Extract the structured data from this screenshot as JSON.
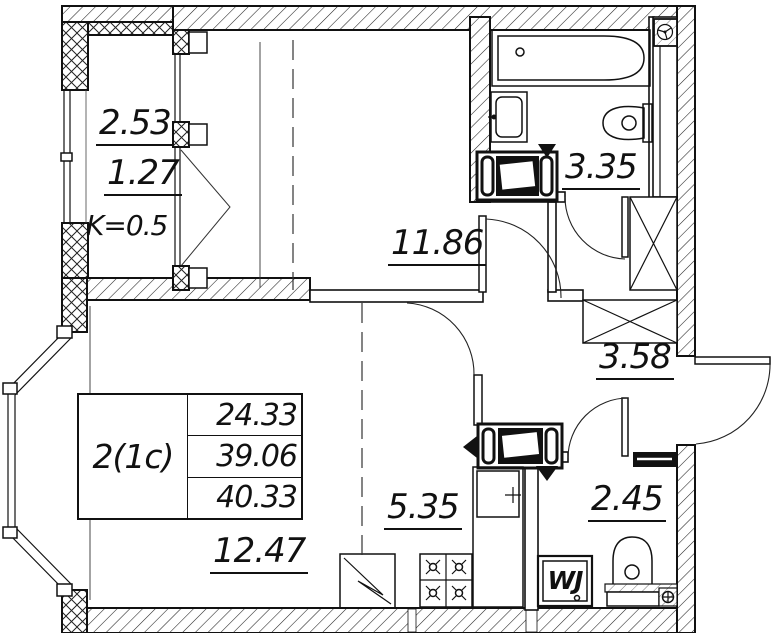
{
  "apartment": {
    "type_label": "2(1c)",
    "areas": {
      "living": "24.33",
      "apartment": "39.06",
      "total": "40.33"
    }
  },
  "rooms": {
    "balcony": {
      "area": "2.53",
      "reduced_area": "1.27",
      "coefficient": "K=0.5"
    },
    "bedroom": {
      "area": "11.86"
    },
    "bathroom": {
      "area": "3.35"
    },
    "hallway": {
      "area": "3.58"
    },
    "living_room": {
      "area": "12.47"
    },
    "kitchen": {
      "area": "5.35"
    },
    "wc": {
      "area": "2.45"
    }
  },
  "appliances": {
    "washing_machine_label": "WJ"
  },
  "colors": {
    "line": "#111111",
    "background": "#ffffff"
  }
}
